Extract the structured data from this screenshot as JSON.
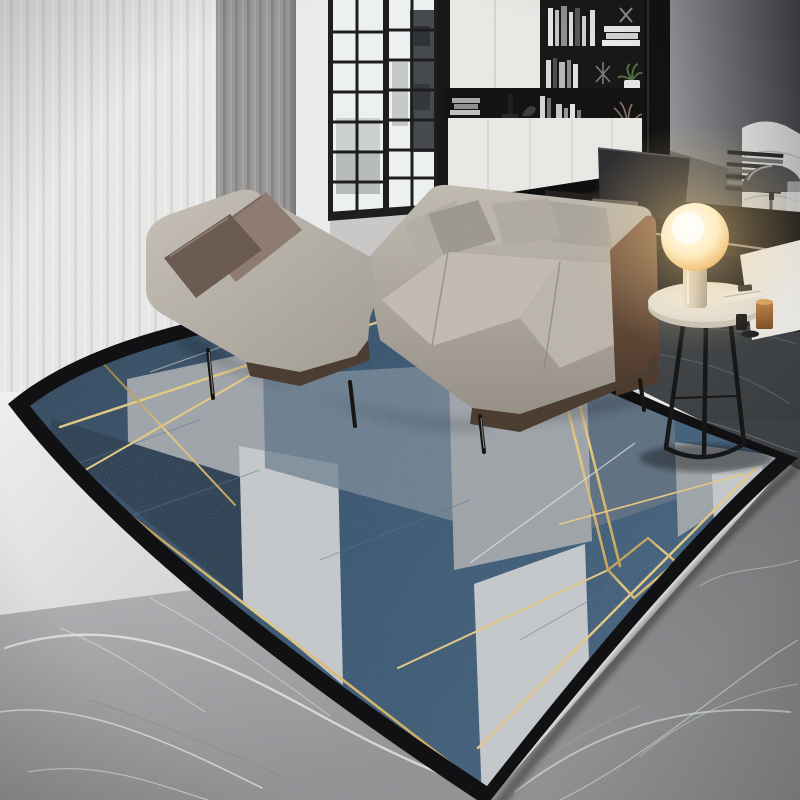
{
  "meta": {
    "description": "Product-style interior photo: modern living room with L-shaped grey sofa, black bookshelf wall, glass partition, glowing orb table lamp and a large geometric navy-and-grey rug with gold pinstripes on grey marble flooring",
    "width": 800,
    "height": 800
  },
  "palette": {
    "curtain_sheer": "#f3f3f1",
    "curtain_sheer_streak": "#e1e1df",
    "curtain_grey": "#989796",
    "curtain_grey_streak": "#878685",
    "wall_white": "#e9ebec",
    "wall_right_light": "#909194",
    "wall_right_dark": "#3e4043",
    "door_frame": "#1b1b1d",
    "glass": "#eef1f2",
    "appliance_dark": "#45484b",
    "shelf_black": "#151515",
    "cabinet_white": "#e9e8e5",
    "plant_green": "#4e6b3f",
    "chair_grey": "#dcdcdc",
    "dome_lamp": "#4a4b4d",
    "desk_dark": "#211e1b",
    "desk_edge_metal": "#9b9287",
    "sofa_light": "#c6c0b7",
    "sofa_mid": "#b4aea5",
    "sofa_dark": "#a29c93",
    "sofa_rail": "#4a3b2f",
    "pillow_taupe": "#8d7a70",
    "pillow_brown": "#6a5950",
    "pillow_grey_light": "#b0aaa1",
    "pillow_grey_dark": "#9d978e",
    "leather_light": "#82604a",
    "leather_dark": "#4a3628",
    "table_top": "#efede8",
    "table_rim": "#c6c2bb",
    "table_leg": "#141414",
    "lamp_core": "#fffdf2",
    "lamp_warm": "#ffeec2",
    "lamp_amber": "#f3c57e",
    "lamp_rim": "#df9b4e",
    "glow": "#ffd78c",
    "copper": "#b5793f",
    "floor_pool_white": "#f0f0ee",
    "floor_light": "#aeb0b2",
    "floor_light_deep": "#8f9193",
    "floor_mid": "#828486",
    "floor_dark": "#35383a",
    "floor_dark_soft": "#4b4e50",
    "vein_white": "#e8eaeb",
    "vein_soft": "#cfd2d3",
    "vein_dark_floor": "#6d7072",
    "rug_navy": "#2e4d6a",
    "rug_navy_deep": "#203548",
    "rug_navy_dark": "#263c52",
    "rug_steel": "#6e8190",
    "rug_steel_band": "#54677a",
    "rug_grey": "#9aa0a5",
    "rug_white": "#c4c8cb",
    "rug_border": "#0e0e10",
    "gold_dark": "#8f6b25",
    "gold_bright": "#e9c97c",
    "gold_mid": "#c9a04a",
    "silver_line": "#dfe3e6",
    "shadow": "#000000"
  },
  "scene": {
    "items": [
      {
        "name": "sheer-curtain",
        "label": "White sheer curtain"
      },
      {
        "name": "grey-curtain",
        "label": "Grey drape panel"
      },
      {
        "name": "glass-partition",
        "label": "Black-framed glass partition with kitchen view"
      },
      {
        "name": "bookshelf",
        "label": "Black shelving unit with white cabinets, books, plant and dried flowers"
      },
      {
        "name": "accent-wall",
        "label": "Dark grey accent wall"
      },
      {
        "name": "office-chair",
        "label": "Light grey office chair"
      },
      {
        "name": "desk",
        "label": "Dark console desk with books, leaning panel and magazine stack"
      },
      {
        "name": "desk-dome-lamp",
        "label": "Dark dome desk lamp"
      },
      {
        "name": "l-shaped-sofa",
        "label": "Light grey L-shaped sofa with brown and grey pillows, leather end panel"
      },
      {
        "name": "side-table",
        "label": "Round white marble side table with black legs"
      },
      {
        "name": "orb-lamp",
        "label": "Glowing spherical table lamp"
      },
      {
        "name": "floor-items",
        "label": "Copper cup and small black vessels"
      },
      {
        "name": "geometric-rug",
        "label": "Navy, grey and white geometric rug with gold pinstripes and black border"
      },
      {
        "name": "marble-floor",
        "label": "Grey veined marble floor, dark near wall, lighter in foreground"
      }
    ]
  }
}
